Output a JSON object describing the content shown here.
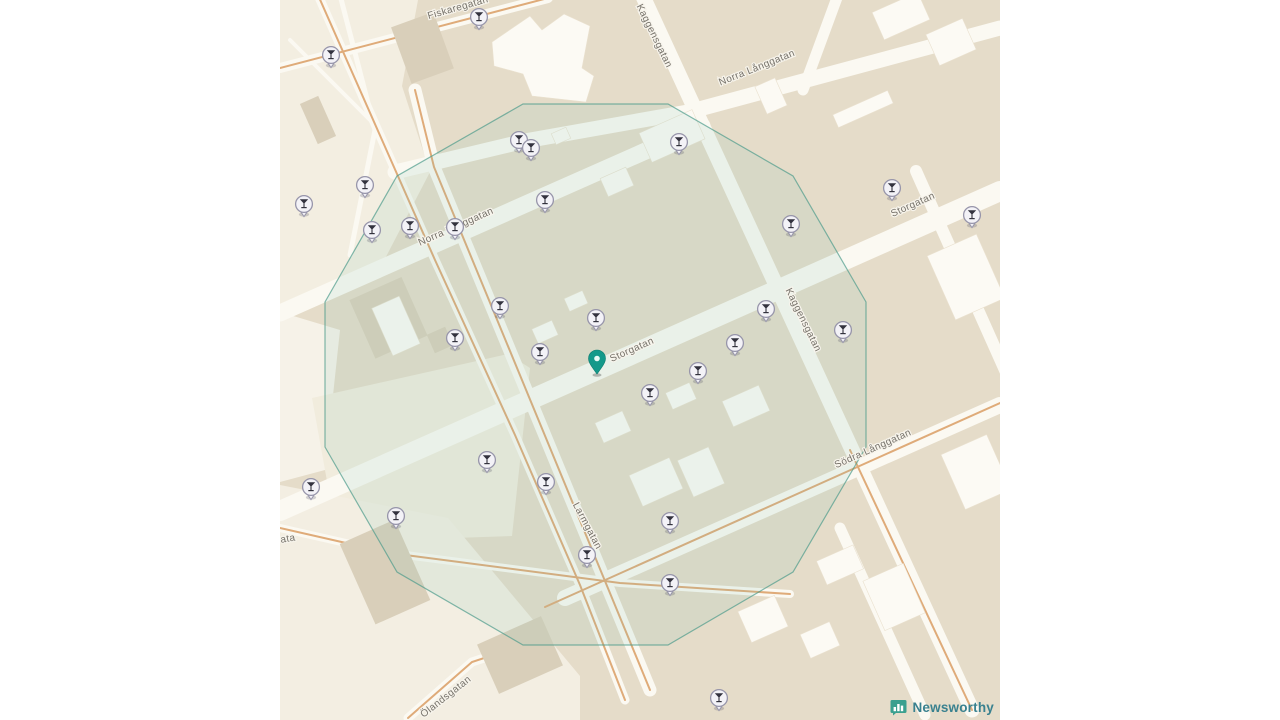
{
  "map": {
    "attribution": {
      "logo_text": "Newsworthy"
    },
    "colors": {
      "accent_teal": "#14998a",
      "radius_stroke": "#4d9b8b",
      "radius_fill": "rgba(125,195,178,0.13)",
      "pin_fill": "#f3f2f7",
      "pin_stroke": "#9795aa",
      "pin_glyph": "#33323e",
      "logo_teal": "#3aa08f"
    },
    "street_labels": [
      {
        "id": "fiskaregatan",
        "text": "Fiskaregatan",
        "x": 178,
        "y": 8,
        "rotate": -16
      },
      {
        "id": "norra-langgatan-w",
        "text": "Norra Långgatan",
        "x": 176,
        "y": 227,
        "rotate": -24
      },
      {
        "id": "norra-langgatan-e",
        "text": "Norra Långgatan",
        "x": 477,
        "y": 68,
        "rotate": -22
      },
      {
        "id": "kaggensgatan-north",
        "text": "Kaggensgatan",
        "x": 374,
        "y": 36,
        "rotate": 64
      },
      {
        "id": "kaggensgatan-east",
        "text": "Kaggensgatan",
        "x": 523,
        "y": 320,
        "rotate": 64
      },
      {
        "id": "storgatan-center",
        "text": "Storgatan",
        "x": 352,
        "y": 350,
        "rotate": -24
      },
      {
        "id": "storgatan-east",
        "text": "Storgatan",
        "x": 633,
        "y": 205,
        "rotate": -24
      },
      {
        "id": "sodra-langgatan",
        "text": "Södra Långgatan",
        "x": 593,
        "y": 449,
        "rotate": -24
      },
      {
        "id": "larmgatan",
        "text": "Larmgatan",
        "x": 307,
        "y": 526,
        "rotate": 62
      },
      {
        "id": "olandsgatan",
        "text": "Ölandsgatan",
        "x": 166,
        "y": 697,
        "rotate": -38
      },
      {
        "id": "gata-edge",
        "text": "ata",
        "x": 8,
        "y": 539,
        "rotate": -10
      }
    ],
    "markers": {
      "center": {
        "x": 317,
        "y": 362
      },
      "venues": [
        {
          "x": 199,
          "y": 17
        },
        {
          "x": 51,
          "y": 55
        },
        {
          "x": 239,
          "y": 140
        },
        {
          "x": 251,
          "y": 148
        },
        {
          "x": 399,
          "y": 142
        },
        {
          "x": 85,
          "y": 185
        },
        {
          "x": 24,
          "y": 204
        },
        {
          "x": 265,
          "y": 200
        },
        {
          "x": 92,
          "y": 230
        },
        {
          "x": 130,
          "y": 226
        },
        {
          "x": 175,
          "y": 227
        },
        {
          "x": 511,
          "y": 224
        },
        {
          "x": 612,
          "y": 188
        },
        {
          "x": 692,
          "y": 215
        },
        {
          "x": 220,
          "y": 306
        },
        {
          "x": 316,
          "y": 318
        },
        {
          "x": 486,
          "y": 309
        },
        {
          "x": 563,
          "y": 330
        },
        {
          "x": 175,
          "y": 338
        },
        {
          "x": 260,
          "y": 352
        },
        {
          "x": 455,
          "y": 343
        },
        {
          "x": 418,
          "y": 371
        },
        {
          "x": 370,
          "y": 393
        },
        {
          "x": 207,
          "y": 460
        },
        {
          "x": 31,
          "y": 487
        },
        {
          "x": 266,
          "y": 482
        },
        {
          "x": 116,
          "y": 516
        },
        {
          "x": 390,
          "y": 521
        },
        {
          "x": 307,
          "y": 555
        },
        {
          "x": 390,
          "y": 583
        },
        {
          "x": 439,
          "y": 698
        }
      ]
    },
    "radius_polygon": {
      "points": [
        [
          586,
          302
        ],
        [
          513,
          176
        ],
        [
          388,
          104
        ],
        [
          243,
          104
        ],
        [
          117,
          176
        ],
        [
          45,
          302
        ],
        [
          45,
          447
        ],
        [
          117,
          572
        ],
        [
          243,
          645
        ],
        [
          388,
          645
        ],
        [
          513,
          572
        ],
        [
          586,
          447
        ]
      ]
    }
  }
}
